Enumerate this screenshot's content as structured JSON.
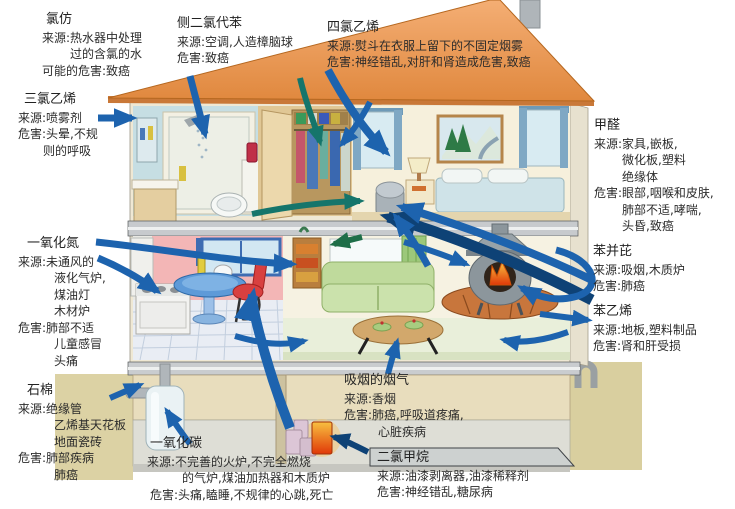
{
  "colors": {
    "roof_orange": "#EC9A5E",
    "roof_edge": "#C97838",
    "arrow_blue": "#1D63AE",
    "arrow_dark_blue": "#0E4276",
    "arrow_teal": "#15756B",
    "arrow_green": "#1E6E48",
    "ground_khaki": "#DCD2A4",
    "wall_cream": "#F0E8D4",
    "kitchen_pink": "#F3B6B6",
    "couch_green": "#BFDA9C",
    "fire_orange": "#F08020"
  },
  "labels": {
    "chloroform": {
      "name": "氯仿",
      "lines": [
        "来源:热水器中处理",
        "过的含氯的水",
        "可能的危害:致癌"
      ]
    },
    "p_dichlorobenzene": {
      "name": "侧二氯代苯",
      "lines": [
        "来源:空调,人造樟脑球",
        "危害:致癌"
      ]
    },
    "tetrachloroethylene": {
      "name": "四氯乙烯",
      "lines": [
        "来源:熨斗在衣服上留下的不固定烟雾",
        "危害:神经错乱,对肝和肾造成危害,致癌"
      ]
    },
    "trichloroethylene": {
      "name": "三氯乙烯",
      "lines": [
        "来源:喷雾剂",
        "危害:头晕,不规",
        "则的呼吸"
      ]
    },
    "nitric_oxide": {
      "name": "一氧化氮",
      "lines": [
        "来源:未通风的",
        "液化气炉,",
        "煤油灯",
        "木材炉",
        "危害:肺部不适",
        "儿童感冒",
        "头痛"
      ]
    },
    "asbestos": {
      "name": "石棉",
      "lines": [
        "来源:绝缘管",
        "乙烯基天花板",
        "地面瓷砖",
        "危害:肺部疾病",
        "肺癌"
      ]
    },
    "formaldehyde": {
      "name": "甲醛",
      "lines": [
        "来源:家具,嵌板,",
        "微化板,塑料",
        "绝缘体",
        "危害:眼部,咽喉和皮肤,",
        "肺部不适,哮喘,",
        "头昏,致癌"
      ]
    },
    "benzopyrene": {
      "name": "苯并芘",
      "lines": [
        "来源:吸烟,木质炉",
        "危害:肺癌"
      ]
    },
    "styrene": {
      "name": "苯乙烯",
      "lines": [
        "来源:地板,塑料制品",
        "危害:肾和肝受损"
      ]
    },
    "tobacco_smoke": {
      "name": "吸烟的烟气",
      "lines": [
        "来源:香烟",
        "危害:肺癌,呼吸道疼痛,",
        "心脏疾病"
      ]
    },
    "carbon_monoxide": {
      "name": "一氧化碳",
      "lines": [
        "来源:不完善的火炉,不完全燃烧",
        "的气炉,煤油加热器和木质炉",
        "危害:头痛,瞌睡,不规律的心跳,死亡"
      ]
    },
    "dichloromethane": {
      "name": "二氯甲烷",
      "lines": [
        "来源:油漆剥离器,油漆稀释剂",
        "危害:神经错乱,糖尿病"
      ]
    }
  }
}
